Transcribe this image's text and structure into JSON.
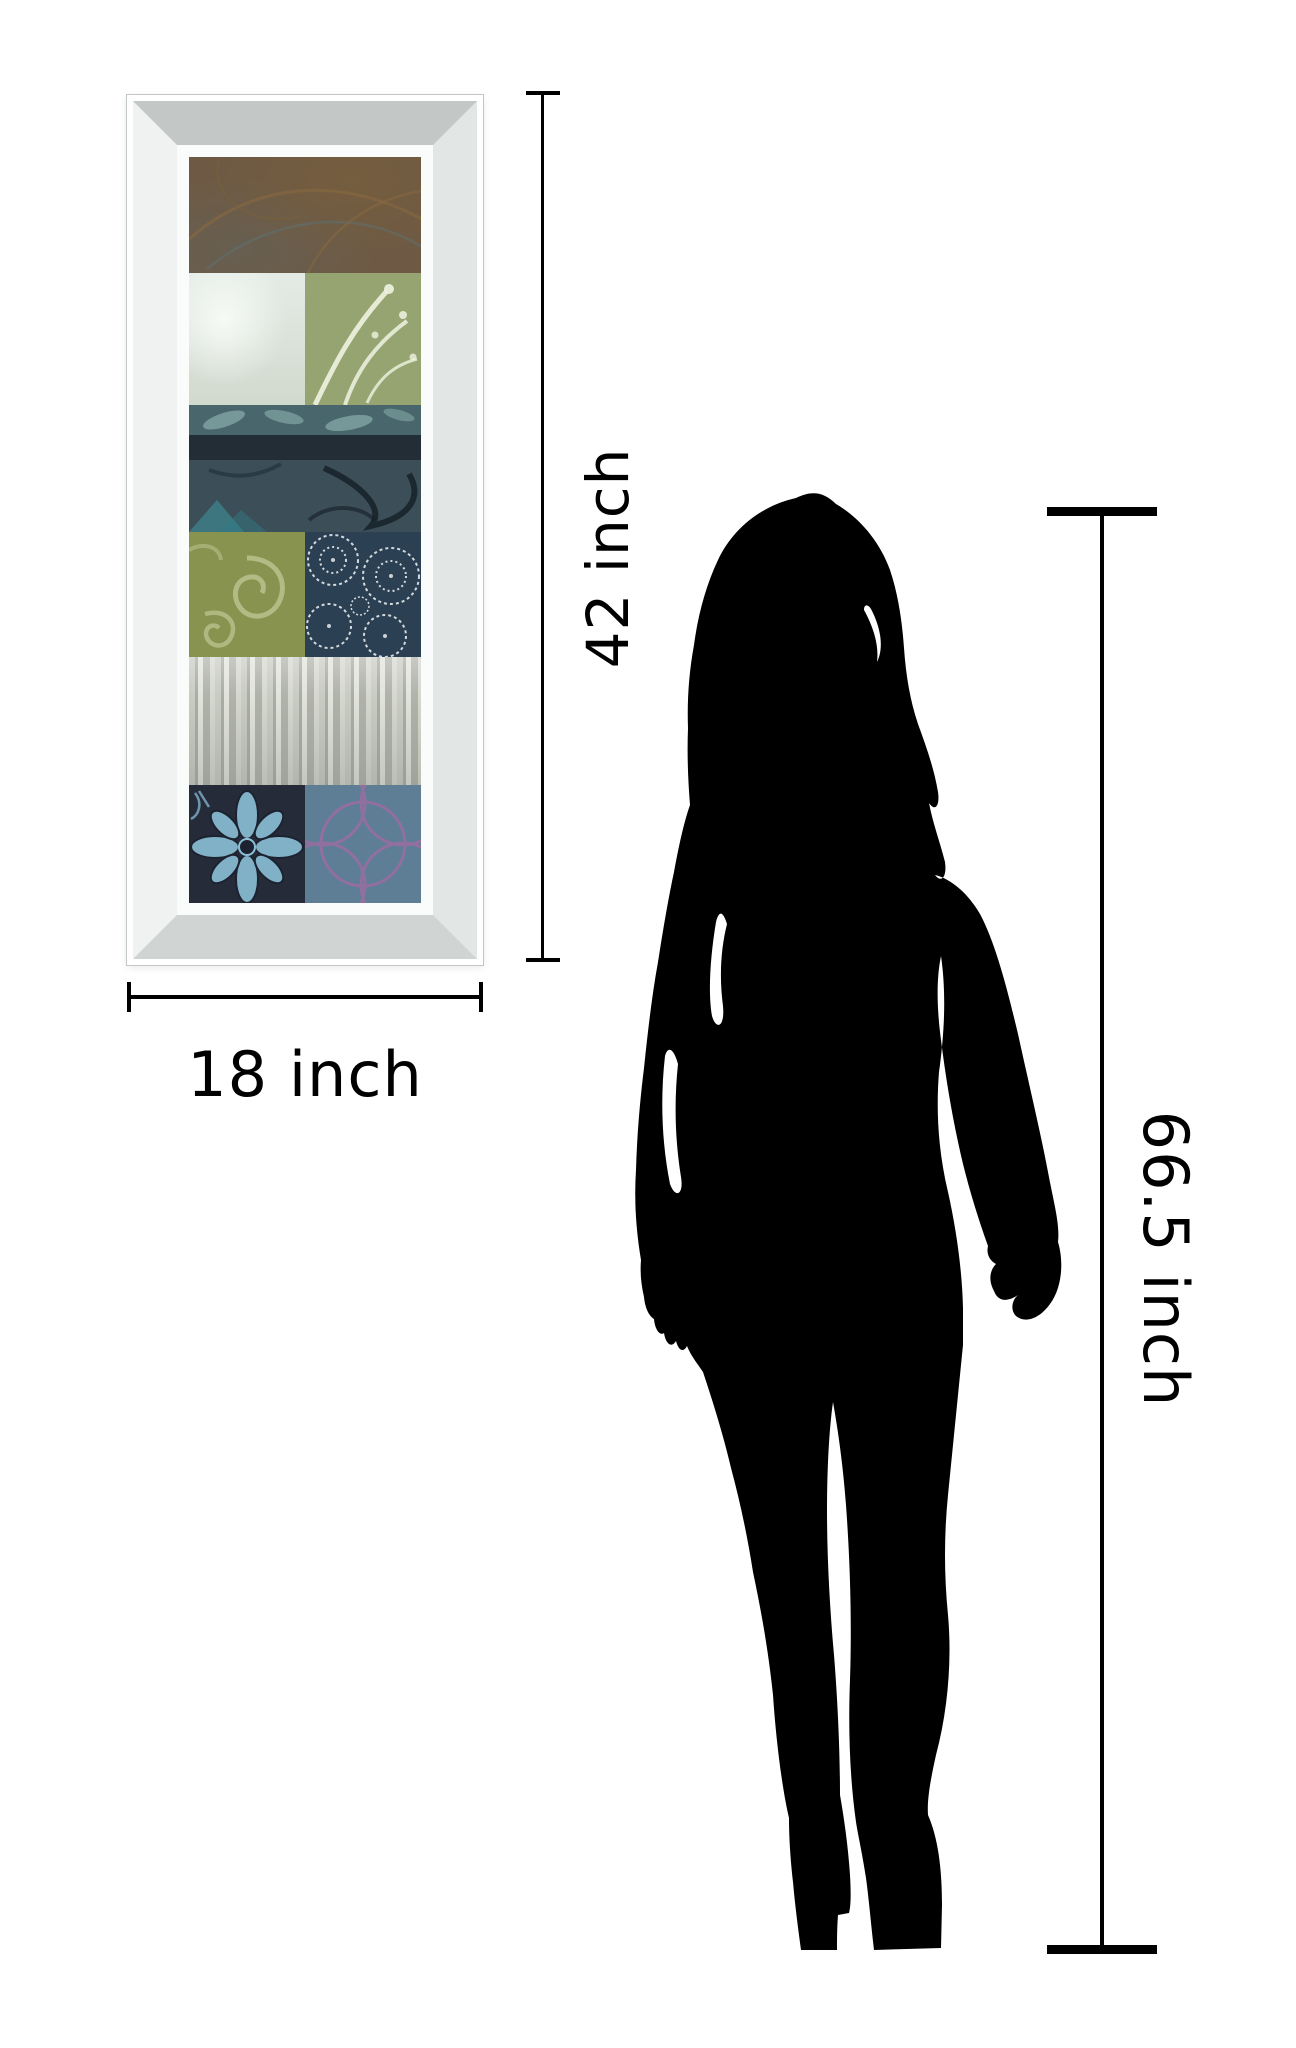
{
  "diagram": {
    "type": "product size comparison",
    "background_color": "#ffffff",
    "line_color": "#000000",
    "text_color": "#000000"
  },
  "artwork": {
    "height_label": "42 inch",
    "width_label": "18 inch",
    "frame_style": "mirrored bevel frame",
    "frame_colors": {
      "outer": "#ffffff",
      "bevel_top": "#c3c8c7",
      "bevel_left": "#f0f2f1",
      "bevel_right": "#e2e6e5",
      "bevel_bottom": "#d0d5d4",
      "inner_lip": "#fafbfb"
    },
    "panels": [
      {
        "name": "rust-swirl-panel",
        "color": "#6e5a44"
      },
      {
        "name": "pale-ice-panel",
        "color": "#e0e8e2"
      },
      {
        "name": "sage-branches-panel",
        "color": "#96a471"
      },
      {
        "name": "teal-leaf-strip",
        "color": "#49666c"
      },
      {
        "name": "dark-navy-strip",
        "color": "#222d35"
      },
      {
        "name": "teal-vine-strip",
        "color": "#3c4f58"
      },
      {
        "name": "olive-spiral-panel",
        "color": "#87934f"
      },
      {
        "name": "navy-lace-panel",
        "color": "#2c4053"
      },
      {
        "name": "silver-birch-panel",
        "color": "#b7bab1"
      },
      {
        "name": "dark-batik-flower-panel",
        "color": "#252b39"
      },
      {
        "name": "slate-circles-panel",
        "color": "#5e7e95"
      }
    ]
  },
  "person": {
    "height_label": "66.5 inch",
    "silhouette_color": "#000000",
    "description": "standing woman silhouette"
  }
}
